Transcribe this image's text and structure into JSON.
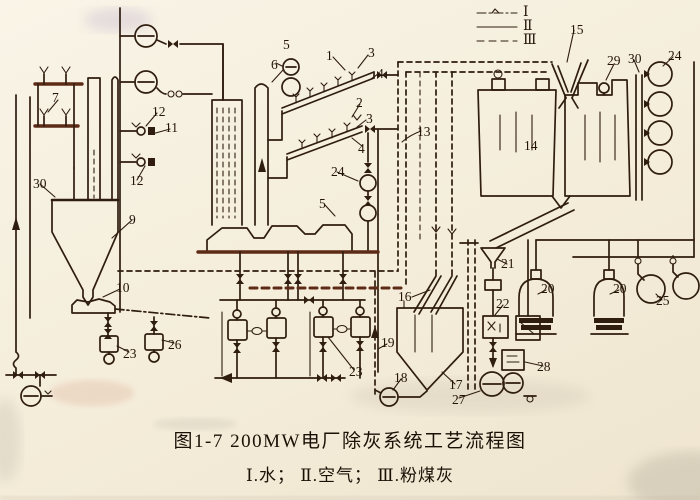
{
  "figure": {
    "caption_line1": "图1-7  200MW电厂除灰系统工艺流程图",
    "caption_line2": "Ⅰ.水； Ⅱ.空气； Ⅲ.粉煤灰"
  },
  "legend": {
    "items": [
      {
        "numeral": "Ⅰ",
        "style": "dash-dot",
        "meaning": "水"
      },
      {
        "numeral": "Ⅱ",
        "style": "solid",
        "meaning": "空气"
      },
      {
        "numeral": "Ⅲ",
        "style": "dashed",
        "meaning": "粉煤灰"
      }
    ]
  },
  "colors": {
    "ink": "#2f1d0f",
    "paper": "#f4edda",
    "stamp_red": "#c8745a"
  },
  "labels": [
    {
      "t": "1",
      "x": 326,
      "y": 49
    },
    {
      "t": "2",
      "x": 356,
      "y": 96
    },
    {
      "t": "3",
      "x": 368,
      "y": 46
    },
    {
      "t": "3",
      "x": 366,
      "y": 112
    },
    {
      "t": "4",
      "x": 377,
      "y": 67
    },
    {
      "t": "4",
      "x": 358,
      "y": 142
    },
    {
      "t": "5",
      "x": 283,
      "y": 38
    },
    {
      "t": "5",
      "x": 319,
      "y": 197
    },
    {
      "t": "6",
      "x": 271,
      "y": 58
    },
    {
      "t": "7",
      "x": 52,
      "y": 91
    },
    {
      "t": "9",
      "x": 129,
      "y": 213
    },
    {
      "t": "10",
      "x": 116,
      "y": 281
    },
    {
      "t": "11",
      "x": 165,
      "y": 121
    },
    {
      "t": "12",
      "x": 152,
      "y": 105
    },
    {
      "t": "12",
      "x": 130,
      "y": 174
    },
    {
      "t": "13",
      "x": 417,
      "y": 125
    },
    {
      "t": "14",
      "x": 524,
      "y": 139
    },
    {
      "t": "15",
      "x": 570,
      "y": 23
    },
    {
      "t": "16",
      "x": 398,
      "y": 290
    },
    {
      "t": "17",
      "x": 449,
      "y": 378
    },
    {
      "t": "18",
      "x": 394,
      "y": 371
    },
    {
      "t": "19",
      "x": 381,
      "y": 336
    },
    {
      "t": "20",
      "x": 541,
      "y": 282
    },
    {
      "t": "20",
      "x": 613,
      "y": 282
    },
    {
      "t": "21",
      "x": 501,
      "y": 257
    },
    {
      "t": "22",
      "x": 496,
      "y": 297
    },
    {
      "t": "23",
      "x": 123,
      "y": 347
    },
    {
      "t": "23",
      "x": 349,
      "y": 365
    },
    {
      "t": "24",
      "x": 331,
      "y": 165
    },
    {
      "t": "24",
      "x": 668,
      "y": 49
    },
    {
      "t": "25",
      "x": 656,
      "y": 294
    },
    {
      "t": "26",
      "x": 168,
      "y": 338
    },
    {
      "t": "27",
      "x": 452,
      "y": 393
    },
    {
      "t": "28",
      "x": 537,
      "y": 360
    },
    {
      "t": "29",
      "x": 607,
      "y": 54
    },
    {
      "t": "30",
      "x": 33,
      "y": 177
    },
    {
      "t": "30",
      "x": 628,
      "y": 52
    }
  ]
}
